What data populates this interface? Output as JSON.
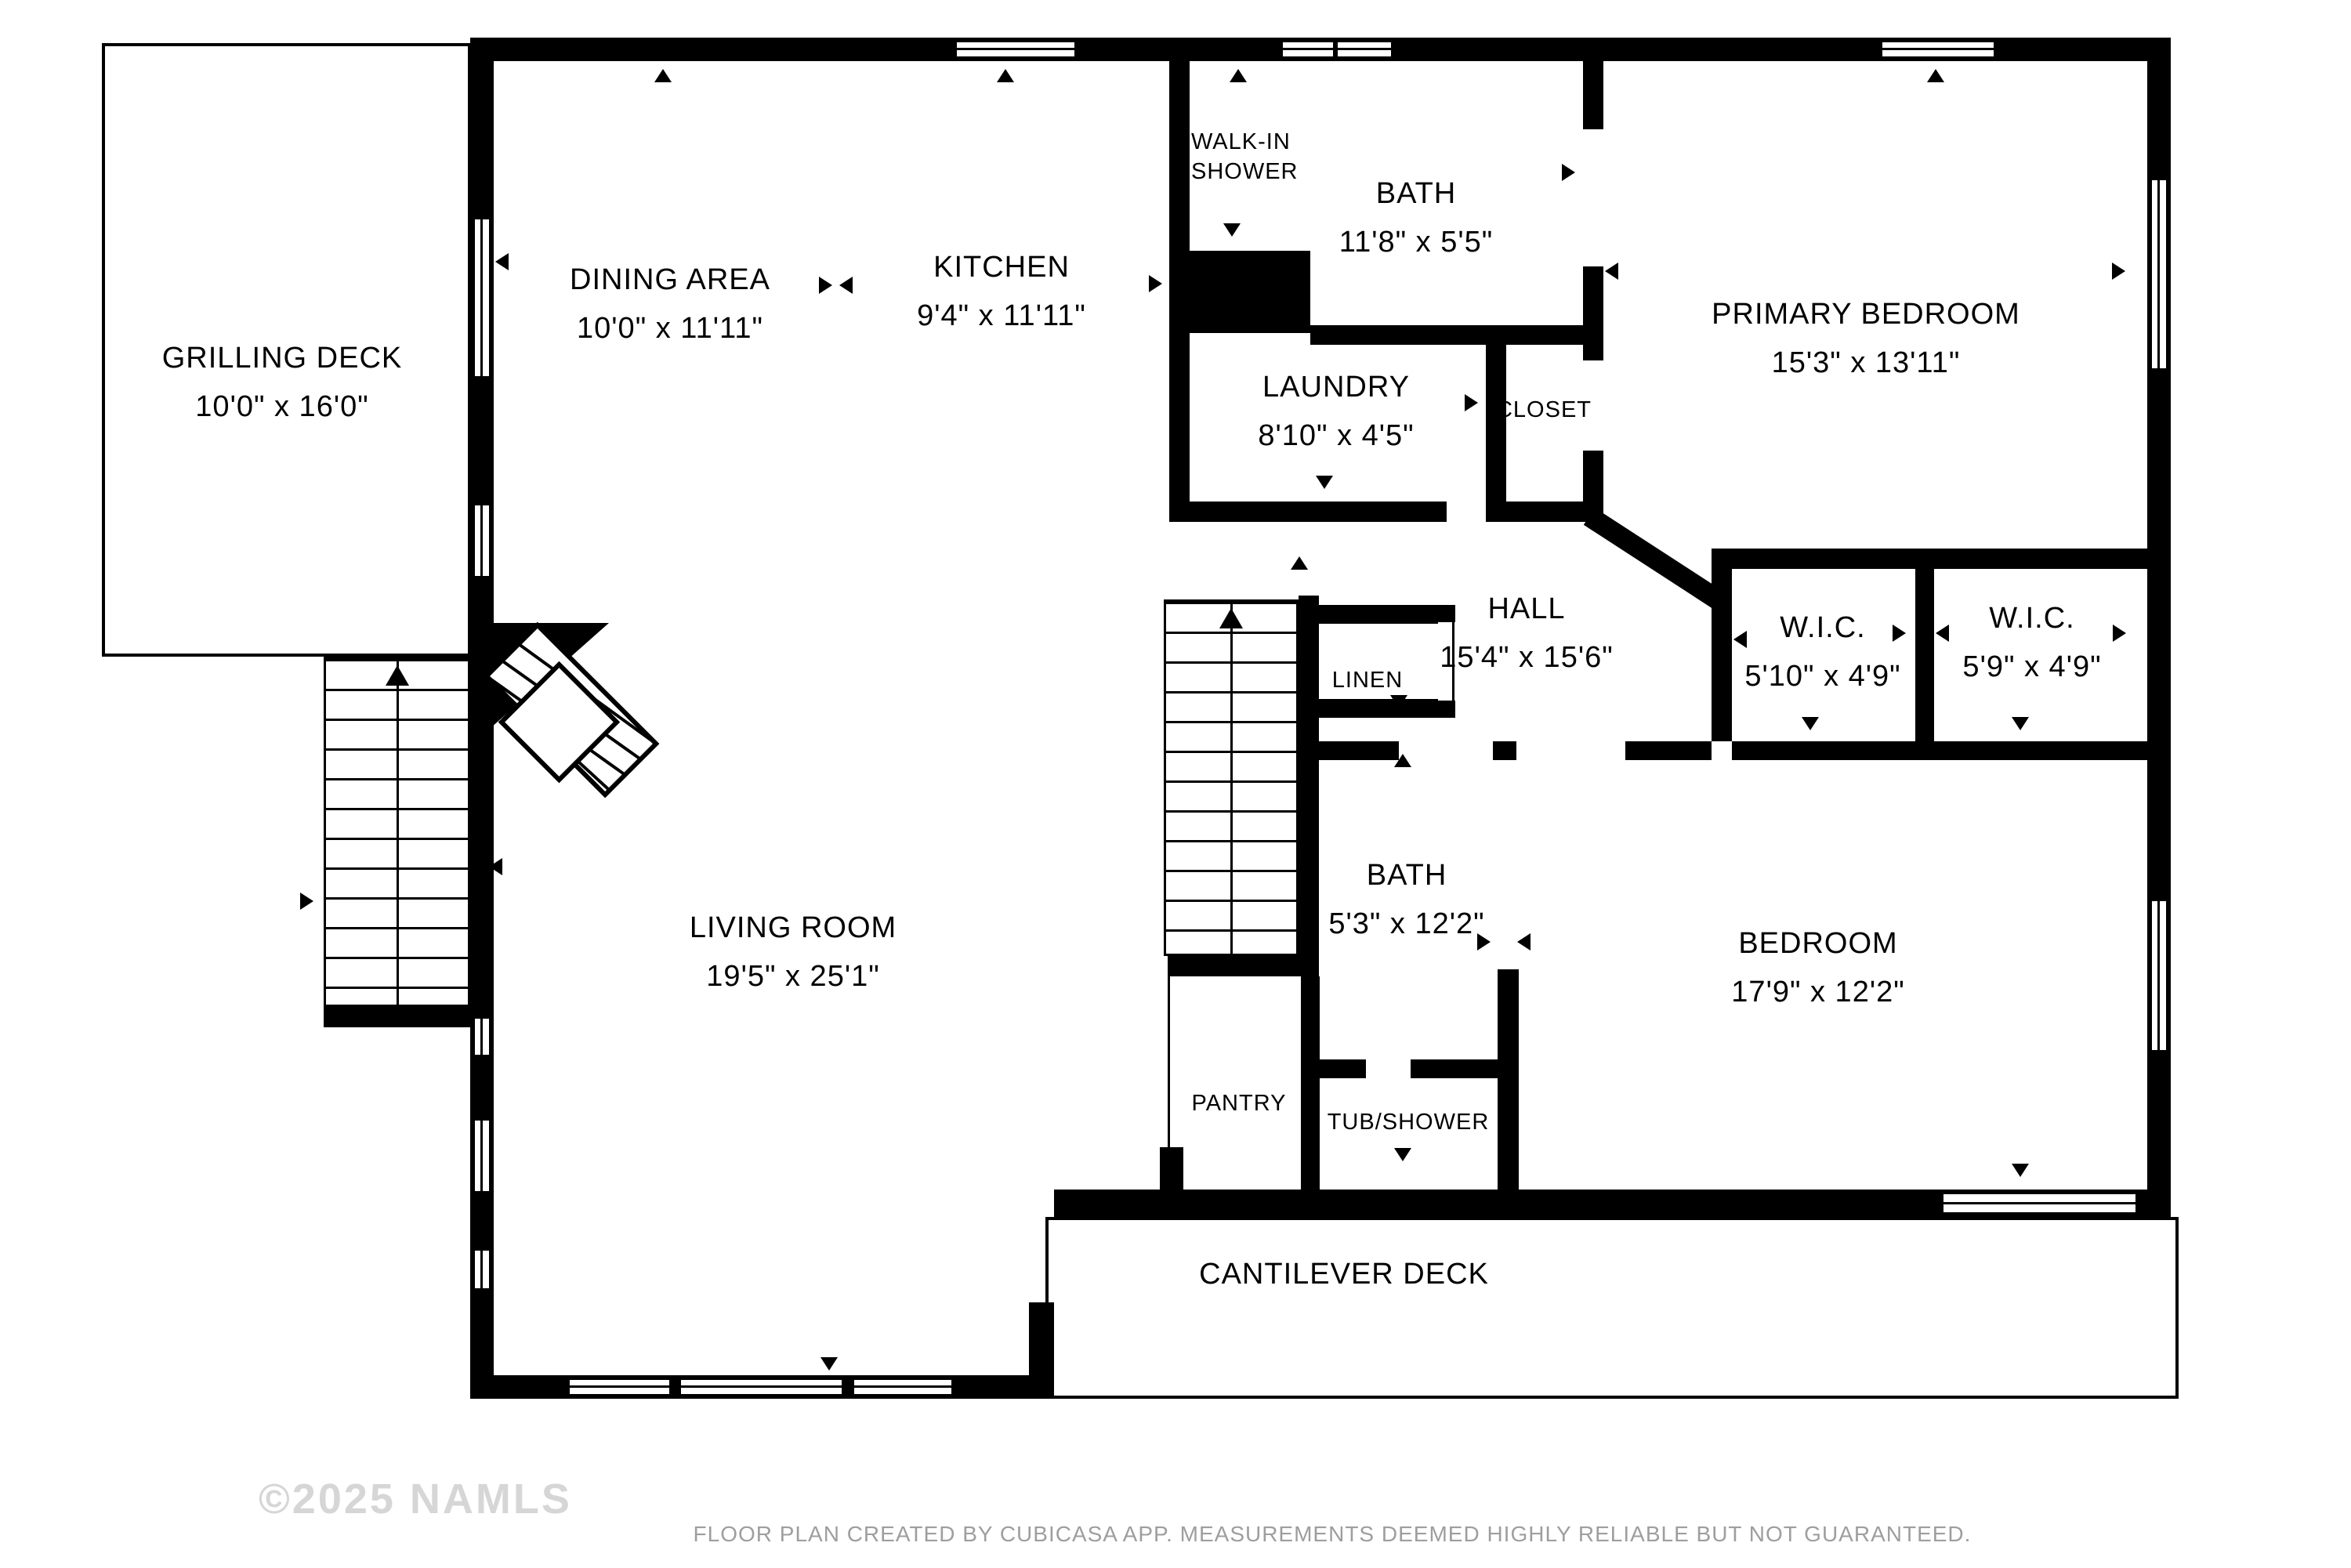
{
  "rooms": {
    "grilling_deck": {
      "name": "GRILLING DECK",
      "dims": "10'0\" x 16'0\""
    },
    "dining_area": {
      "name": "DINING AREA",
      "dims": "10'0\" x 11'11\""
    },
    "kitchen": {
      "name": "KITCHEN",
      "dims": "9'4\" x 11'11\""
    },
    "bath_upper": {
      "name": "BATH",
      "dims": "11'8\" x 5'5\""
    },
    "primary_bedroom": {
      "name": "PRIMARY BEDROOM",
      "dims": "15'3\" x 13'11\""
    },
    "laundry": {
      "name": "LAUNDRY",
      "dims": "8'10\" x 4'5\""
    },
    "hall": {
      "name": "HALL",
      "dims": "15'4\" x 15'6\""
    },
    "wic_1": {
      "name": "W.I.C.",
      "dims": "5'10\" x 4'9\""
    },
    "wic_2": {
      "name": "W.I.C.",
      "dims": "5'9\" x 4'9\""
    },
    "living_room": {
      "name": "LIVING ROOM",
      "dims": "19'5\" x 25'1\""
    },
    "bath_lower": {
      "name": "BATH",
      "dims": "5'3\" x 12'2\""
    },
    "bedroom": {
      "name": "BEDROOM",
      "dims": "17'9\" x 12'2\""
    }
  },
  "labels": {
    "walk_in_shower_line1": "WALK-IN",
    "walk_in_shower_line2": "SHOWER",
    "closet": "CLOSET",
    "linen": "LINEN",
    "pantry": "PANTRY",
    "tub_shower": "TUB/SHOWER",
    "cantilever_deck": "CANTILEVER DECK"
  },
  "watermark": "©2025 NAMLS",
  "footer": "FLOOR PLAN CREATED BY CUBICASA APP. MEASUREMENTS DEEMED HIGHLY RELIABLE BUT NOT GUARANTEED.",
  "colors": {
    "wall": "#000000",
    "watermark": "#d6d6d6",
    "footer": "#9e9e9e"
  }
}
